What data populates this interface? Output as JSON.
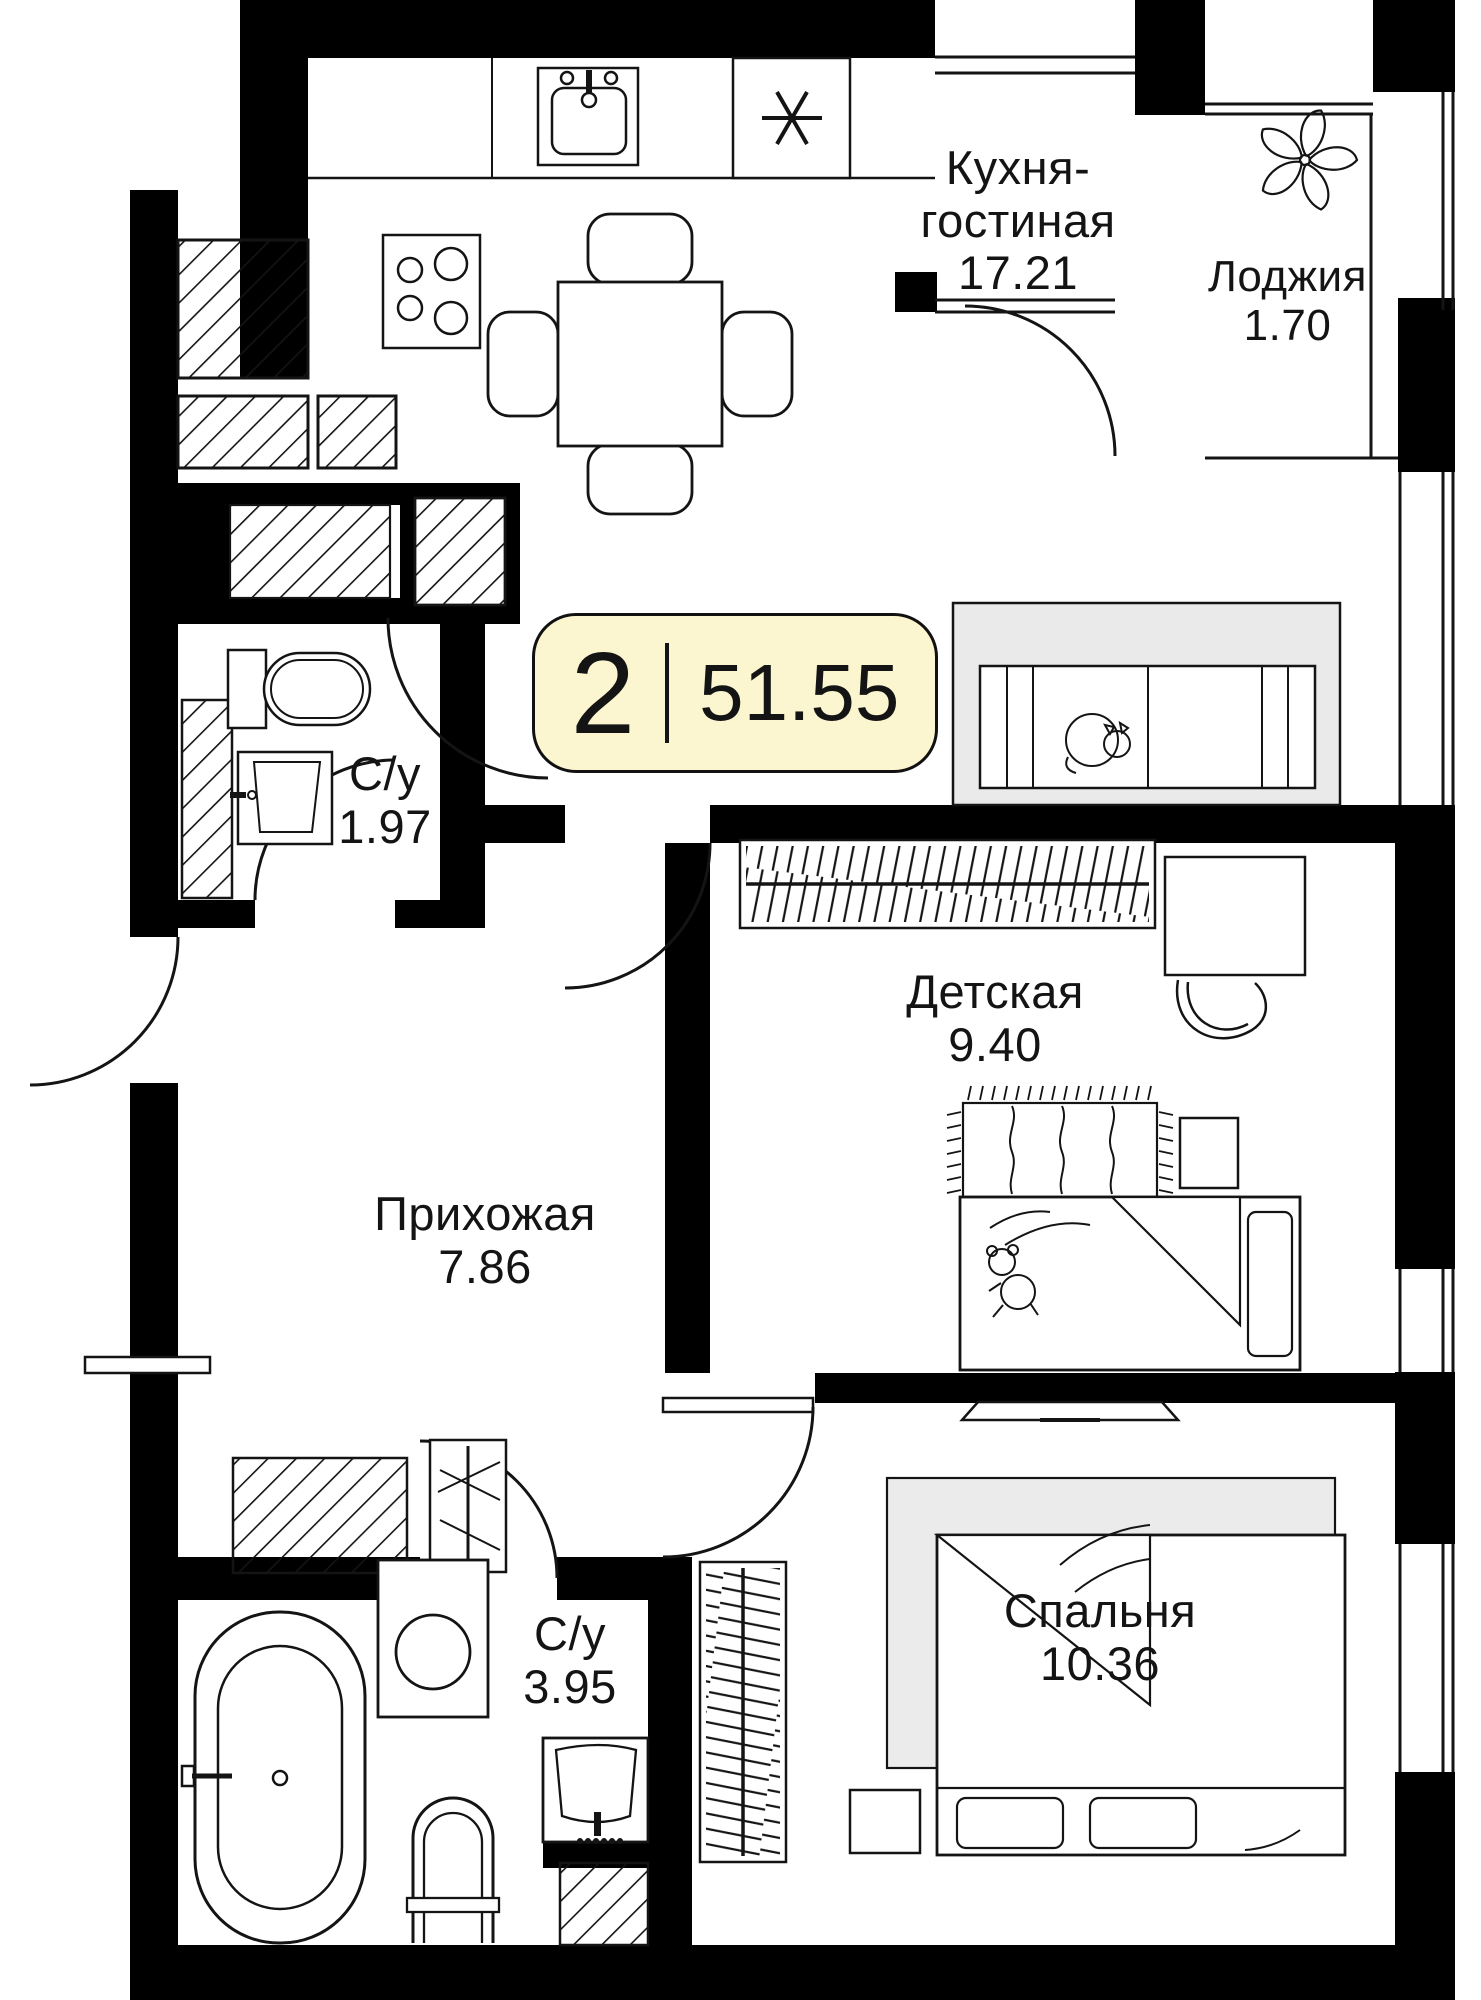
{
  "badge": {
    "room_count": "2",
    "total_area": "51.55"
  },
  "rooms": {
    "kitchen_living": {
      "name_line1": "Кухня-",
      "name_line2": "гостиная",
      "area": "17.21"
    },
    "loggia": {
      "name": "Лоджия",
      "area": "1.70"
    },
    "bathroom_small": {
      "name": "С/у",
      "area": "1.97"
    },
    "children_room": {
      "name": "Детская",
      "area": "9.40"
    },
    "hallway": {
      "name": "Прихожая",
      "area": "7.86"
    },
    "bathroom_large": {
      "name": "С/у",
      "area": "3.95"
    },
    "bedroom": {
      "name": "Спальня",
      "area": "10.36"
    }
  },
  "colors": {
    "wall": "#000000",
    "line": "#141414",
    "badge_fill": "#FBF6CF",
    "sofa_zone_fill": "#EAEAEA",
    "rug_fill": "#EBEBEB",
    "background": "#FFFFFF"
  },
  "icons": {
    "fridge_snowflake": "✳",
    "list": [
      "kitchen-sink-icon",
      "stove-icon",
      "fridge-snowflake-icon",
      "dining-table-icon",
      "sofa-icon",
      "sleeping-cat-icon",
      "flower-icon",
      "toilet-icon",
      "washbasin-icon",
      "bathtub-icon",
      "washing-machine-icon",
      "wardrobe-icon",
      "desk-icon",
      "desk-chair-icon",
      "rug-icon",
      "bed-icon",
      "teddy-bear-icon",
      "tv-icon",
      "nightstand-icon"
    ]
  }
}
